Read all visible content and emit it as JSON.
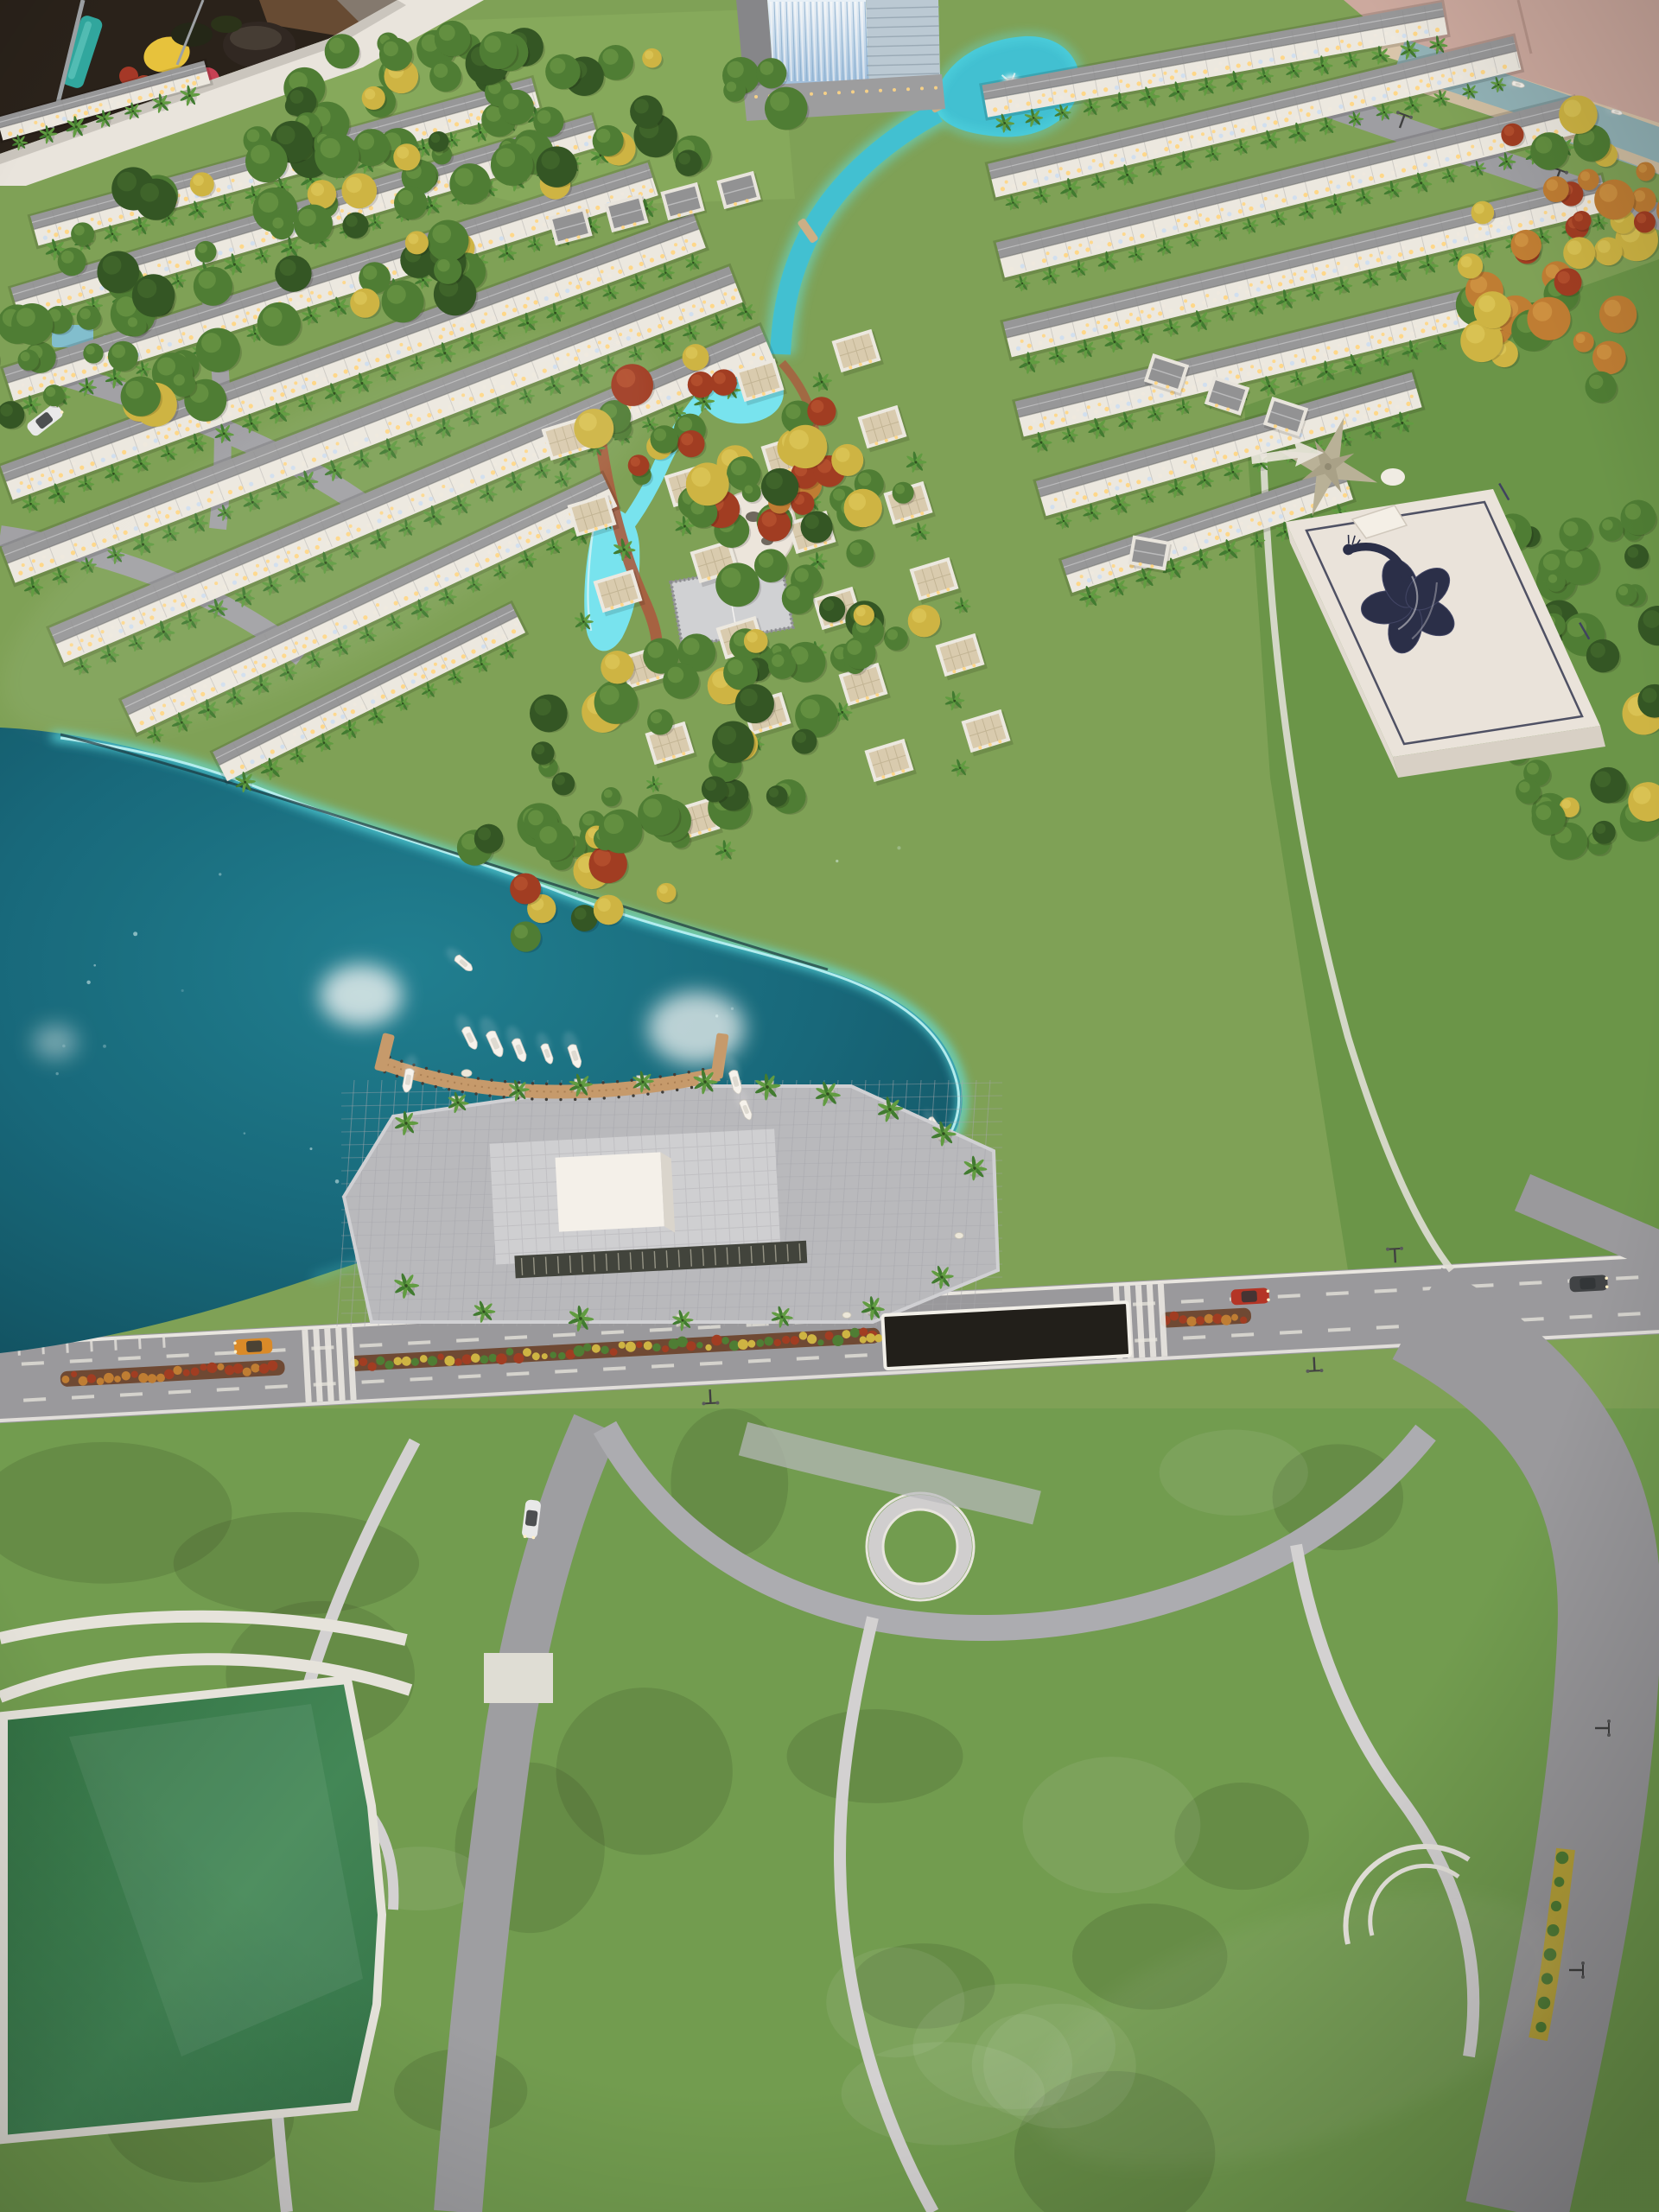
{
  "photo": {
    "subject": "aerial view of an architectural scale model of a resort residential estate",
    "setting": "showroom display table with glass reflection, fruit decor visible beyond top-left model edge"
  },
  "billboard": {
    "brand": "LA VIDA",
    "subtitle": "RESIDENCES",
    "logo": "peacock-flower-logo",
    "panel_color": "#eae6df",
    "logo_color": "#252c49",
    "text_color": "#333a58"
  },
  "street_sign": {
    "text": "ĐƯỜNG CẦU CHÁY",
    "bg": "#1b1b19",
    "border": "#f2f2ee",
    "text_color": "#f5f5f1"
  },
  "scale_marker": {
    "text": "SCALE 1/250",
    "color": "#d9ddc9"
  },
  "palette": {
    "grass": "#7ba257",
    "grass_dark": "#567f3b",
    "park_green": "#6e9c50",
    "forest": "#3f6b2f",
    "forest_dark": "#2d5124",
    "field_green": "#2f7a4b",
    "lake_deep": "#0d5d72",
    "lake_mid": "#17809a",
    "lake_glow": "#5ce9f2",
    "pool": "#74e6f4",
    "canal": "#3cc2d6",
    "river": "#8fb3ba",
    "road": "#97999f",
    "road_line": "#e9e9e6",
    "path": "#d2d3d6",
    "paver": "#b7bac1",
    "house_wall": "#ecebe5",
    "house_roof": "#94979b",
    "window_warm": "#ffd887",
    "window_cool": "#cfe2f5",
    "dock_wood": "#c59a6d",
    "boat": "#f6f5f1",
    "tree_green": "#4a7c34",
    "tree_dark": "#2e5424",
    "tree_yellow": "#d0b94c",
    "tree_red": "#a43b24",
    "tree_orange": "#c27f36",
    "palm": "#3b7a30",
    "sand": "#d8c7ae",
    "base_board": "#cbaaa2",
    "tower_glass": "#cfe4f7",
    "fruit_yellow": "#e7c43c",
    "fruit_red": "#b5402e",
    "teal_object": "#2ba8a2"
  }
}
